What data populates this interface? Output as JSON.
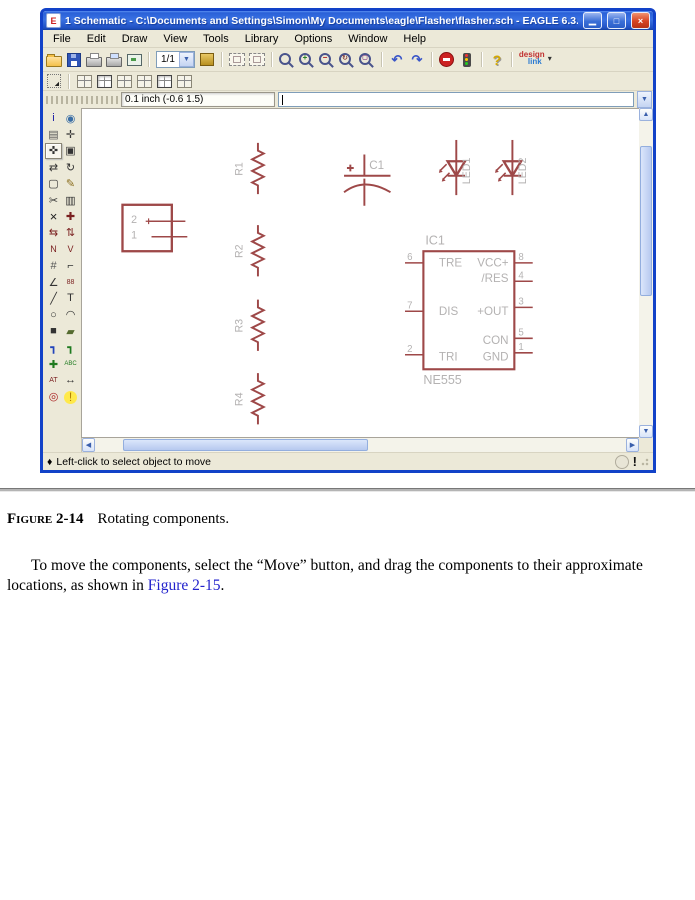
{
  "window": {
    "title": "1 Schematic - C:\\Documents and Settings\\Simon\\My Documents\\eagle\\Flasher\\flasher.sch - EAGLE 6.3.0 Light",
    "menu_items": [
      "File",
      "Edit",
      "Draw",
      "View",
      "Tools",
      "Library",
      "Options",
      "Window",
      "Help"
    ],
    "toolbar": {
      "sheet_value": "1/1",
      "designlink_top": "design",
      "designlink_bottom": "link"
    },
    "command_bar": {
      "coord_display": "0.1 inch (-0.6 1.5)",
      "command_value": ""
    },
    "palette_tools": [
      "info",
      "show",
      "display",
      "mark",
      "move",
      "copy",
      "mirror",
      "rotate",
      "group",
      "change",
      "cut",
      "paste",
      "delete",
      "add",
      "pinswap",
      "gateswap",
      "name",
      "value",
      "smash",
      "miter",
      "split",
      "invoke",
      "wire",
      "text",
      "circle",
      "arc",
      "rect",
      "polygon",
      "bus",
      "net",
      "junction",
      "label",
      "attribute",
      "dimension",
      "erc",
      "errors"
    ],
    "palette_selected": "move",
    "status_bullet": "♦",
    "status_text": "Left-click to select object to move"
  },
  "schematic": {
    "connector": {
      "pin_2": "2",
      "pin_1": "1"
    },
    "r1": "R1",
    "r2": "R2",
    "r3": "R3",
    "r4": "R4",
    "c1": "C1",
    "c1_polarity": "+",
    "led1": "LED1",
    "led2": "LED2",
    "ic": {
      "name": "IC1",
      "value": "NE555",
      "pin6_num": "6",
      "pin6_label": "TRE",
      "pin7_num": "7",
      "pin7_label": "DIS",
      "pin2_num": "2",
      "pin2_label": "TRI",
      "pin8_num": "8",
      "pin8_label": "VCC+",
      "pin4_num": "4",
      "pin4_label": "/RES",
      "pin3_num": "3",
      "pin3_label": "+OUT",
      "pin5_num": "5",
      "pin5_label": "CON",
      "pin1_num": "1",
      "pin1_label": "GND"
    }
  },
  "document": {
    "caption_label": "Figure 2-14",
    "caption_text": "Rotating components.",
    "para_before_link": "To move the components, select the “Move” button, and drag the components to their approximate locations, as shown in ",
    "para_link": "Figure 2-15",
    "para_after_link": "."
  }
}
